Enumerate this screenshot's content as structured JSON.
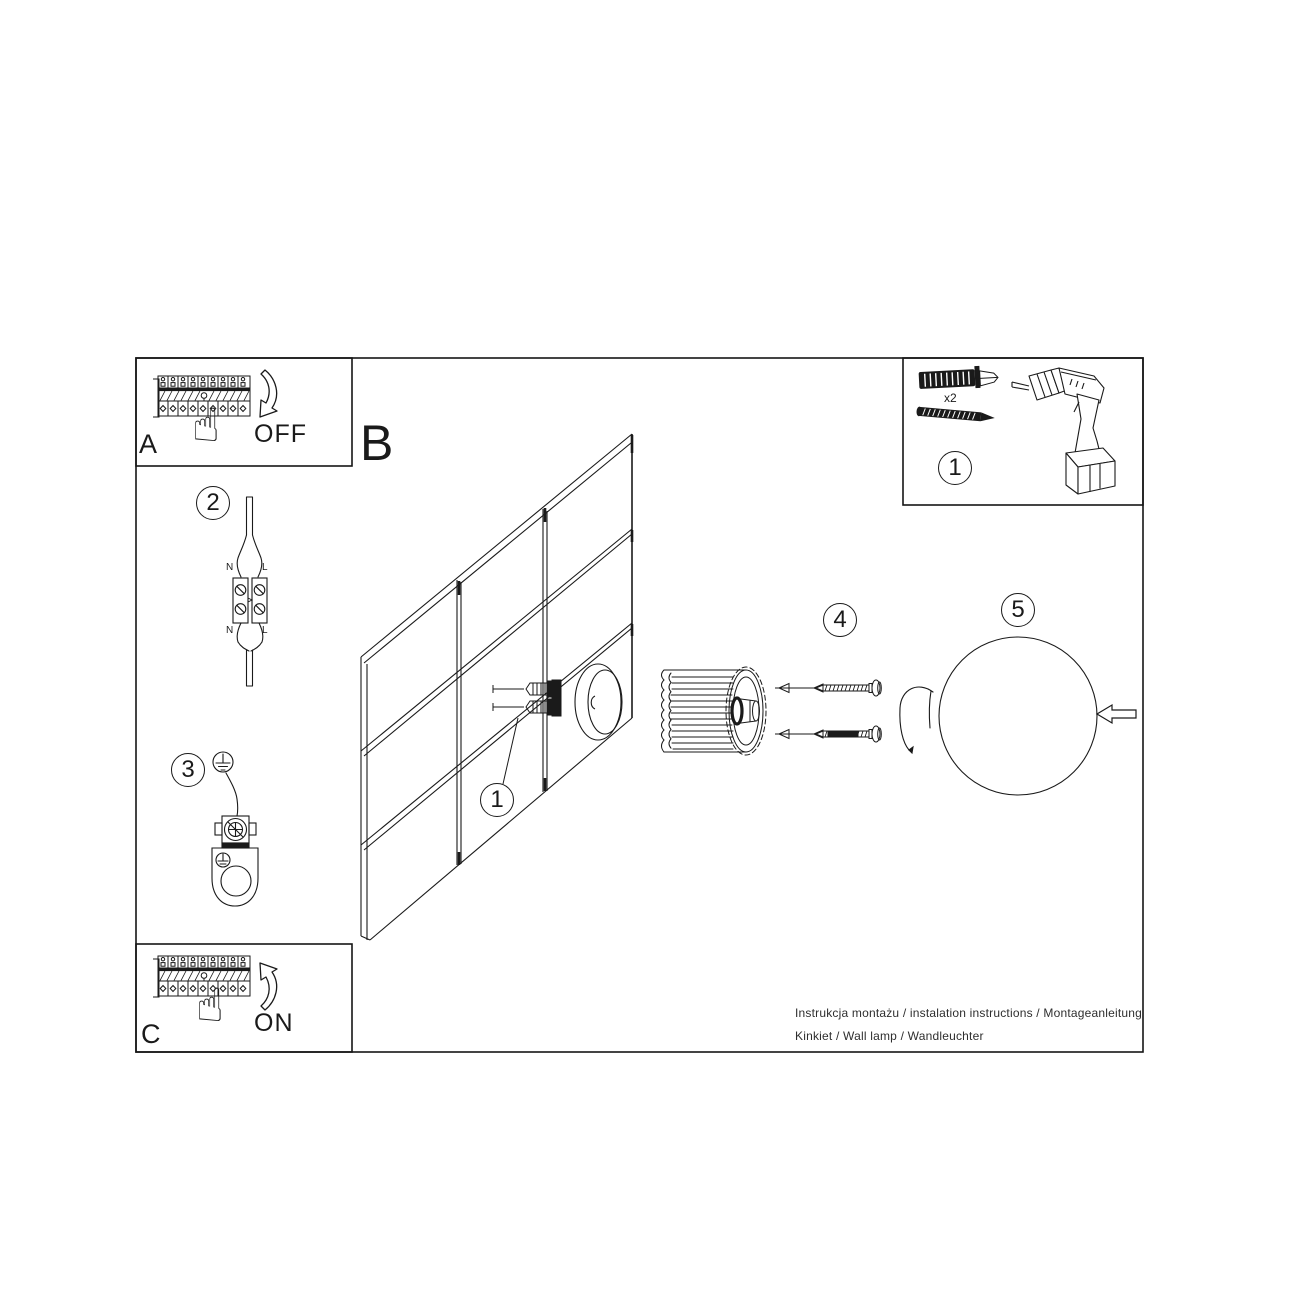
{
  "sheet": {
    "panel_a": {
      "label": "A",
      "state": "OFF"
    },
    "panel_c": {
      "label": "C",
      "state": "ON"
    },
    "main": {
      "label": "B"
    },
    "badges": {
      "step1_wall": "1",
      "step2": "2",
      "step3": "3",
      "step4": "4",
      "step5": "5",
      "step1_tools": "1"
    },
    "tools": {
      "anchor_qty": "x2"
    },
    "wiring": {
      "top": {
        "n": "N",
        "l": "L"
      },
      "bottom": {
        "n": "N",
        "l": "L"
      }
    },
    "footer": {
      "line1": "Instrukcja montażu / instalation instructions / Montageanleitung",
      "line2": "Kinkiet / Wall lamp / Wandleuchter"
    },
    "colors": {
      "line": "#1a1a1a",
      "background": "#ffffff"
    }
  }
}
